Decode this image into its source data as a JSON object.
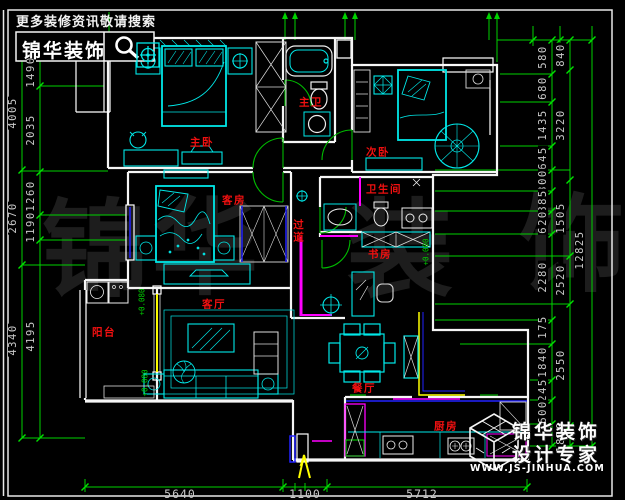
{
  "header": {
    "tagline": "更多装修资讯敬请搜索",
    "brand": "锦华装饰"
  },
  "footer": {
    "brand": "锦华装饰",
    "slogan": "设计专家",
    "url": "WWW.JS-JINHUA.COM"
  },
  "watermark": {
    "char1": "锦",
    "char2": "华",
    "char3": "装",
    "char4": "饰"
  },
  "rooms": {
    "master_bedroom": "主卧",
    "master_bath": "主卫",
    "second_bedroom": "次卧",
    "guest_room": "客房",
    "hallway": "过道",
    "bathroom": "卫生间",
    "study": "书房",
    "living_room": "客厅",
    "balcony": "阳台",
    "dining_room": "餐厅",
    "kitchen": "厨房"
  },
  "tags": {
    "elevation": "+0.000",
    "balcony_tag_top": "+0.080",
    "balcony_tag_bottom": "+0.080"
  },
  "dimensions": {
    "left_outer": [
      "4005",
      "2670",
      "4340"
    ],
    "left_inner": [
      "1490",
      "2035",
      "1260",
      "1190",
      "4195"
    ],
    "right_inner": [
      "580",
      "680",
      "1435",
      "645",
      "300",
      "885",
      "620",
      "2280",
      "175",
      "1840",
      "245",
      "600"
    ],
    "right_middle": [
      "840",
      "3220",
      "1505",
      "2520",
      "2550",
      "1850"
    ],
    "right_outer": [
      "12825"
    ],
    "bottom": [
      "5640",
      "1100",
      "5712"
    ]
  }
}
